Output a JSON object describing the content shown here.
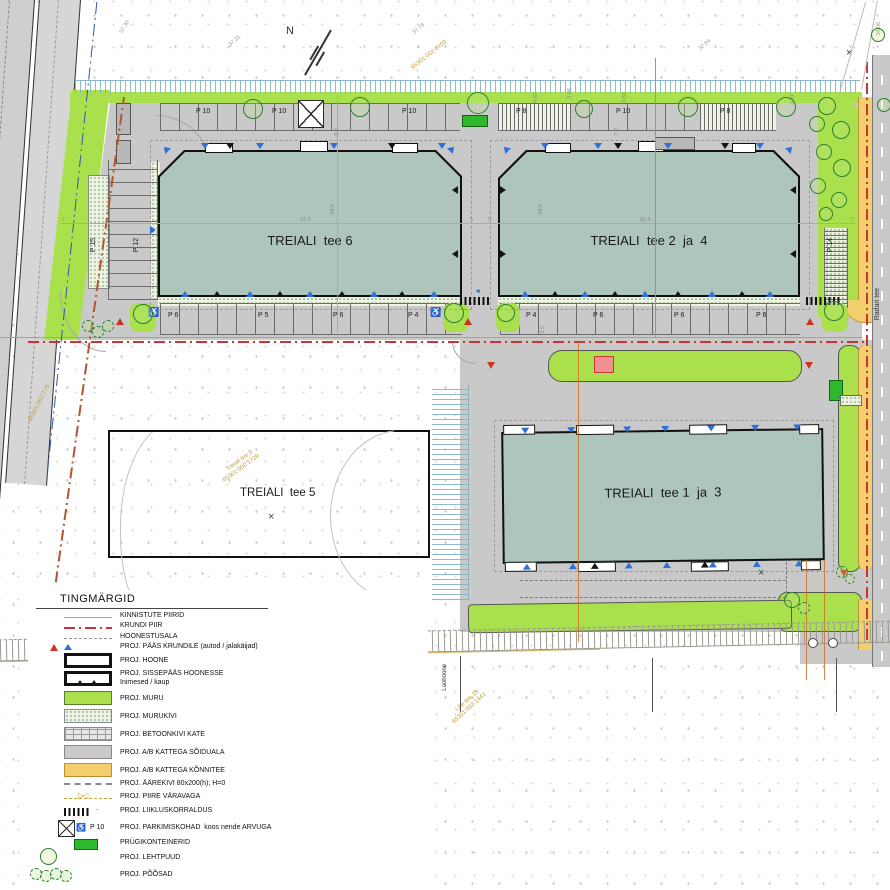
{
  "plan": {
    "north_label": "N",
    "buildings": {
      "b6": "TREIALI  tee 6",
      "b24": "TREIALI  tee 2  ja  4",
      "b13": "TREIALI  tee 1  ja  3",
      "b5": "TREIALI  tee 5"
    },
    "roads": {
      "radari": "Radari tee"
    },
    "parking": {
      "b6_top": [
        "P 10",
        "P 10",
        "P 10"
      ],
      "b6_bottom": [
        "P 6",
        "P 5",
        "P 6",
        "P 4"
      ],
      "b6_left": "P 12",
      "left_strip": "P 15",
      "b24_top": [
        "P 8",
        "P 10",
        "P 8"
      ],
      "b24_bottom": [
        "P 4",
        "P 6",
        "P 6",
        "P 6"
      ],
      "b24_right": "P 14"
    },
    "cadastral": {
      "top_area": "65301:002:0703",
      "tee5_name": "Treiali tee 5",
      "tee5_num": "65301:002:1729",
      "left_area": "65301:002:779",
      "lille17_name": "Lille tee 17",
      "lille17_num": "65301:002:0758",
      "lille19_name": "Lille tee 19",
      "lille19_num": "65301:002:1441",
      "laohoone": "Laohoone"
    },
    "dimensions": {
      "w6": "91.0",
      "h6": "39.8",
      "w24": "91.0",
      "h24": "39.8",
      "gap": "8.2",
      "d72": "7.2",
      "d35": "3.5",
      "d346": "3.46",
      "d467": "4.67",
      "d381": "3.81",
      "d407": "4.07",
      "n5a": "5",
      "n5b": "5",
      "n7a": "7",
      "n7b": "7"
    },
    "elevations": {
      "e1": "37.21",
      "e2": "37.78",
      "e3": "37.84",
      "e4": "37.30",
      "e5": "38.06"
    }
  },
  "legend": {
    "title": "TINGMÄRGID",
    "items": [
      {
        "label": "KINNISTUTE PIIRID"
      },
      {
        "label": "KRUNDI PIIR"
      },
      {
        "label": "HOONESTUSALA"
      },
      {
        "label": "PROJ. PÄÄS KRUNDILE (autod / jalakäijad)"
      },
      {
        "label": "PROJ. HOONE"
      },
      {
        "label": "PROJ. SISSEPÄÄS HOONESSE",
        "label2": "Inimesed / kaup"
      },
      {
        "label": "PROJ. MURU"
      },
      {
        "label": "PROJ. MURUKIVI"
      },
      {
        "label": "PROJ. BETOONKIVI KATE"
      },
      {
        "label": "PROJ. A/B KATTEGA SÕIDUALA"
      },
      {
        "label": "PROJ. A/B KATTEGA KÕNNITEE"
      },
      {
        "label": "PROJ. ÄÄREKIVI 80x200(h); H=0"
      },
      {
        "label": "PROJ. PIIRE VÄRAVAGA"
      },
      {
        "label": "PROJ. LIIKLUSKORRALDUS"
      },
      {
        "label": "PROJ. PARKIMISKOHAD  koos nende ARVUGA",
        "count_label": "P 10"
      },
      {
        "label": "PRÜGIKONTEINERID"
      },
      {
        "label": "PROJ. LEHTPUUD"
      },
      {
        "label": "PROJ. PÕÕSAD"
      }
    ]
  },
  "colors": {
    "muru": "#a9e04c",
    "building": "#aec5bb",
    "pavement": "#c9c9c9",
    "konnitee": "#f3cf6e",
    "container": "#2eb82e",
    "access_car": "#cc3322",
    "access_ped": "#2e6fd8",
    "krundi_piir": "#cc3333"
  }
}
